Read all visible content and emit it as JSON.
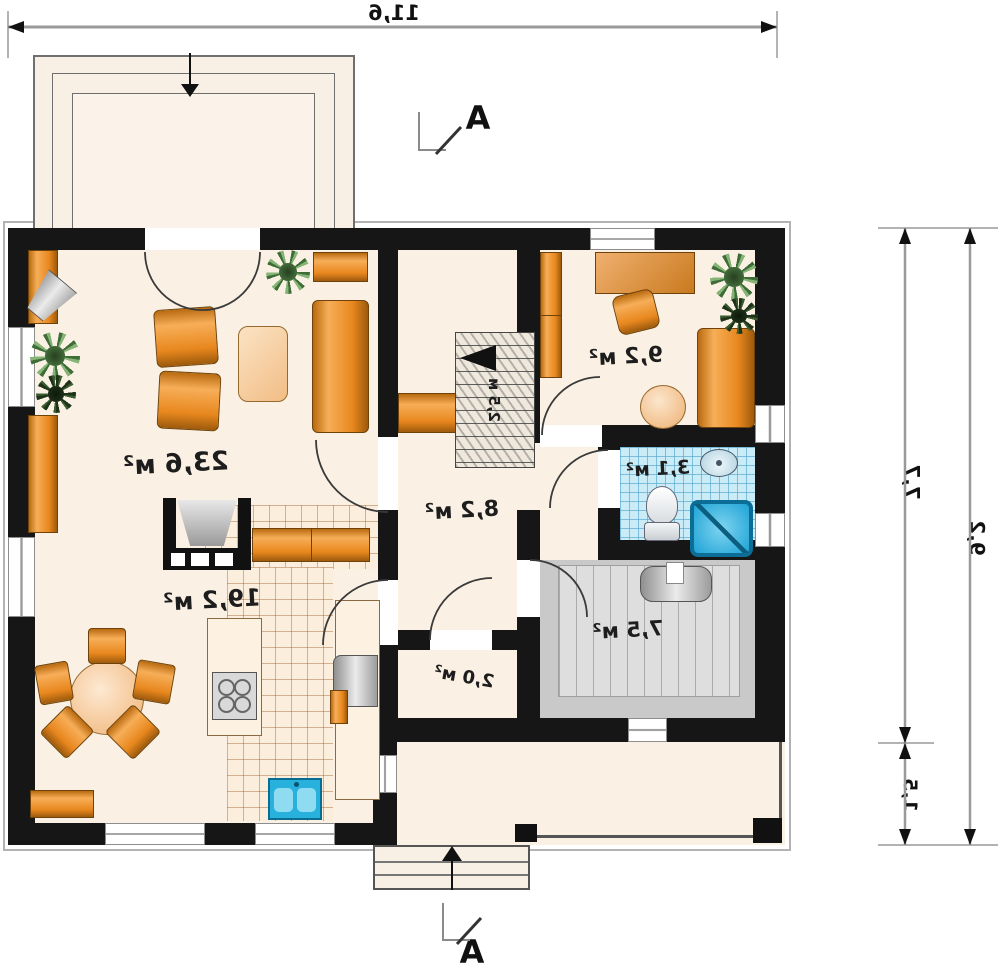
{
  "plan": {
    "dimensions": {
      "width_top": "11,6",
      "height_upper": "7,7",
      "height_lower": "1,5",
      "height_total": "9,2"
    },
    "section": {
      "label_top": "A",
      "label_bottom": "A"
    },
    "rooms": {
      "living": {
        "area": "23,6 м²"
      },
      "kitchen": {
        "area": "19,2 м²"
      },
      "hall": {
        "area": "8,2 м²"
      },
      "office": {
        "area": "9,2 м²"
      },
      "bathroom": {
        "area": "3,1 м²"
      },
      "utility": {
        "area": "7,5 м²"
      },
      "closet": {
        "area": "2,0 м²"
      },
      "stairs": {
        "width_label": "2,5 м"
      }
    },
    "colors": {
      "wall": "#161616",
      "floor": "#faf1e4",
      "furniture_orange": "#e8871e",
      "tile_blue": "#c9ecf7",
      "utility_gray": "#c9c9c9",
      "fixture_blue": "#2ab1dd"
    }
  }
}
